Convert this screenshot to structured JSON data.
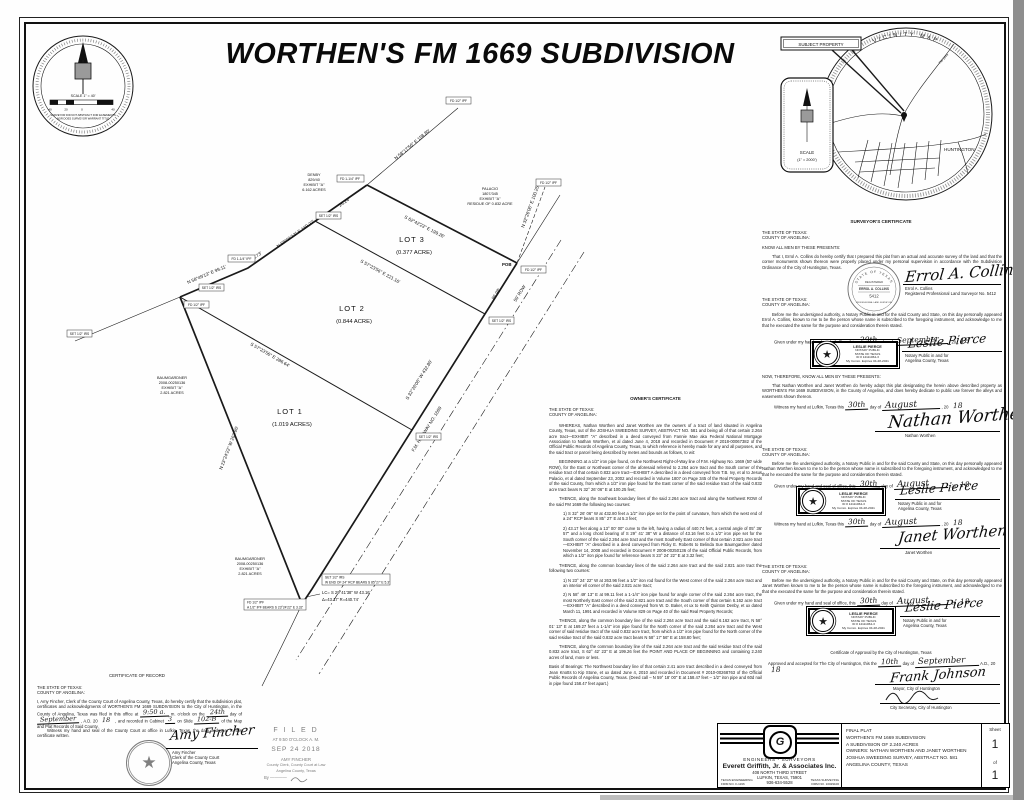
{
  "page": {
    "title": "WORTHEN'S FM 1669 SUBDIVISION"
  },
  "compass": {
    "scale": "SCALE  1\" = 40'",
    "tick1": "40",
    "tick2": "20",
    "tick3": "0",
    "tick4": "40",
    "disclaimer1": "SURVEYOR DID NOT ABSTRACT FOR EASEMENTS",
    "disclaimer2": "NOR DOES SURVEYOR WARRANT TITLE"
  },
  "vicinity": {
    "ring_title": "VICINITY  MAP",
    "subject": "SUBJECT  PROPERTY",
    "town": "HUNTINGTON",
    "road": "FM 1669",
    "scale1": "SCALE",
    "scale2": "(1\" = 2000')"
  },
  "plat": {
    "lot1_name": "LOT 1",
    "lot1_area": "(1.019 ACRES)",
    "lot2_name": "LOT 2",
    "lot2_area": "(0.844 ACRE)",
    "lot3_name": "LOT 3",
    "lot3_area": "(0.377 ACRE)",
    "bearing_ab": "S 62°42'23\" E  199.26'",
    "bearing_div1": "S 57°23'56\" E  221.16'",
    "bearing_div2": "S 57°23'56\" E  286.64'",
    "bearing_cd": "N 23°24'22\" W  263.96'",
    "bearing_df": "N 58°49'13\" E  99.11'",
    "bearing_fa": "N 58°01'13\" E  169.27'",
    "bearing_road": "S 32°26'06\" W  432.80'",
    "bearing_ref_a": "N 58°17'56\" E  158.80'",
    "bearing_ref_b": "N 32°26'06\" E  100.25'",
    "seg_road": "86.98'",
    "seg_fa": "63.73'",
    "seg_ab": "26.24'",
    "road_name": "F.M. HIGHWAY NO. 1669",
    "row": "50' ROW",
    "pob": "POB",
    "curve1": "LC= S 29°41'38\" W  43.16'",
    "curve2": "Δ=43.17'  R=440.74'",
    "m_ipf": "FD 1/2\" IPF",
    "m_ipf114": "FD 1-1/4\" IPF",
    "m_irs": "SET 1/2\" IRS",
    "note_rcp": "W END OF 24\" RCP BEARS S 85°27' E  5.3'",
    "note_ref": "A 1/2\" IPF BEARS S 23°24'22\" E  3.32'",
    "adj_denby": [
      "DENBY",
      "829/40",
      "EXHIBIT \"A\"",
      "6.162 ACRES"
    ],
    "adj_palacio": [
      "PALACIO",
      "1807/345",
      "EXHIBIT \"A\"",
      "RESIDUE OF 0.832 ACRE"
    ],
    "adj_baum": [
      "BAUMGARDNER",
      "2008-00250136",
      "EXHIBIT \"A\"",
      "2.821 ACRES"
    ]
  },
  "common": {
    "state": "THE STATE OF TEXAS:",
    "county": "COUNTY OF ANGELINA:",
    "know_all": "KNOW ALL MEN BY THESE PRESENTS:",
    "day_of": "day of",
    "year_pre": ", 20",
    "given_pre": "Given under my hand and seal of office, this",
    "witness_pre": "Witness my hand at Lufkin, Texas this",
    "notary_cap1": "Notary Public in and for",
    "notary_cap2": "Angelina County, Texas"
  },
  "owner_cert": {
    "heading": "OWNER'S CERTIFICATE",
    "paragraphs": [
      "WHEREAS, Nathan Worthen and Janet Worthen are the owners of a tract of land situated in Angelina County, Texas, out of the JOSHUA SWEEDING SURVEY, ABSTRACT NO. 581 and being all of that certain 2.264 acre tract—EXHIBIT \"A\" described in a deed conveyed from Fannie Mae aka Federal National Mortgage Association to Nathan Worthen, et al dated June 4, 2018 and recorded in Document # 2018-00067382 of the Official Public Records of Angelina County, Texas, to which reference is hereby made for any and all purposes, and the said tract or parcel being described by metes and bounds as follows, to wit:",
      "BEGINNING at a 1/2\" iron pipe found, on the Northwest Right-of-Way line of F.M. Highway No. 1669 (50' wide ROW), for the East or Northeast corner of the aforesaid referred to 2.264 acre tract and the South corner of the residue tract of that certain 0.832 acre tract—EXHIBIT A described in a deed conveyed from T.B. Ivy, et al to Jesus Palacio, et al dated September 23, 2002 and recorded in Volume 1807 on Page 345 of the Real Property Records of the said County, from which a 1/2\" iron pipe found for the East corner of the said residue tract of the said 0.832 acre tract bears N 32° 26' 06\" E at 100.25 feet;",
      "THENCE, along the Southeast boundary lines of the said 2.264 acre tract and along the Northwest ROW of the said FM 1669 the following two courses:",
      "1)   S 32° 26' 06\" W at 432.80 feet a 1/2\" iron pipe set for the point of curvature, from which the west end of a 24\" RCP bears S 85° 27' E at 5.3 feet;",
      "2)   43.17 feet along a 13° 00' 00\" curve to the left, having a radius of 440.74 feet, a central angle of 05° 36' 57\" and a long chord bearing of S 29° 41' 38\" W a distance of 43.16 feet to a 1/2\" iron pipe set for the South corner of the said 2.264 acre tract and the most Southerly East corner of that certain 2.821 acre tract—EXHIBIT \"A\" described in a deed conveyed from Ricky E. Roberts to Belinda Sue Baumgardner dated November 14, 2008 and recorded in Document # 2008-00250136 of the said Official Public Records, from which a 1/2\" iron pipe found for reference bears S 23° 24' 22\" E at 3.32 feet;",
      "THENCE, along the common boundary lines of the said 2.264 acre tract and the said 2.821 acre tract the following two courses:",
      "1)   N 23° 24' 22\" W at 263.96 feet a 1/2\" iron rod found for the West corner of the said 2.264 acre tract and an interior ell corner of the said 2.821 acre tract;",
      "2)   N 58° 49' 13\" E at 99.11 feet a 1-1/4\" iron pipe found for angle corner of the said 2.264 acre tract, the most Northerly East corner of the said 2.821 acre tract and the South corner of that certain 6.162 acre tract—EXHIBIT \"A\" described in a deed conveyed from W. D. Baker, et ux to Keith Quinton Denby, et ux dated March 11, 1991 and recorded in Volume 829 on Page 40 of the said Real Property Records;",
      "THENCE, along the common boundary line of the said 2.264 acre tract and the said 6.162 acre tract, N 58° 01' 13\" E at 169.27 feet a 1-1/4\" iron pipe found for the North corner of the said 2.264 acre tract and the West corner of said residue tract of the said 0.832 acre tract, from which a 1/2\" iron pipe found for the North corner of the said residue tract of the said 0.832 acre tract bears N 58° 17' 56\" E at 158.80 feet;",
      "THENCE, along the common boundary line of the said 2.264 acre tract and the said residue tract of the said 0.832 acre tract, S 62° 42' 23\" E at 199.26 feet the POINT AND PLACE OF BEGINNING and containing 2.240 acres of land, more or less.",
      "Basis of Bearings: The Northwest boundary line of that certain 2.41 acre tract described in a deed conveyed from Jean Knotts to Kip Stone, et ux dated June 4, 2010 and recorded in Document # 2010-00268763 of the Official Public Records of Angelina County, Texas. (Deed call – N 59° 18' 00\" E at 158.47 feet – 1/2\" iron pipe and 60d nail in pipe found 158.47 feet apart.)"
    ]
  },
  "surveyor_cert": {
    "heading": "SURVEYOR'S CERTIFICATE",
    "body": "That I, Errol A. Collins do hereby certify that I prepared this plat from an actual and accurate survey of the land and that the corner monuments shown thereon were properly placed under my personal supervision in accordance with the Subdivision Ordinance of the City of Huntington, Texas.",
    "seal_arc_top": "STATE OF TEXAS",
    "seal_registered": "REGISTERED",
    "seal_name": "ERROL A. COLLINS",
    "seal_num": "5412",
    "seal_bottom": "PROFESSIONAL LAND SURVEYOR",
    "sig": "Errol A. Collins",
    "sig_name": "Errol A. Collins",
    "sig_title": "Registered Professional Land Surveyor No. 5412",
    "ack_body": "Before me the undersigned authority, a Notary Public in and for the said County and State, on this day personally appeared Errol A. Collins, known to me to be the person whose name is subscribed to the foregoing instrument, and acknowledge to me that he executed the same for the purpose and consideration therein stated.",
    "day": "29th",
    "month": "September",
    "year": "18"
  },
  "notary_stamp": {
    "name": "LESLIE PIERCE",
    "l2": "NOTARY PUBLIC",
    "l3": "STATE OF TEXAS",
    "l4": "ID # 12111064-3",
    "l5": "My Comm. Expires 04-28-2021",
    "sig": "Leslie Pierce",
    "star": "★"
  },
  "dedication": {
    "now_therefore": "NOW,  THEREFORE,  KNOW ALL MEN BY THESE PRESENTS:",
    "body": "That Nathan Worthen and Janet Worthen do hereby adopt this plat designating the herein above described property as WORTHEN'S FM 1669 SUBDIVISION, in the County of Angelina, and does hereby dedicate to public use forever the alleys and easements shown thereon.",
    "nathan_day": "30th",
    "nathan_month": "August",
    "nathan_year": "18",
    "nathan_sig": "Nathan Worthen",
    "nathan_name": "Nathan Worthen",
    "janet_day": "30th",
    "janet_month": "August",
    "janet_year": "18",
    "janet_sig": "Janet Worthen",
    "janet_name": "Janet Worthen"
  },
  "ack_nathan": {
    "body": "Before me the undersigned authority, a Notary Public in and for the said County and State, on this day personally appeared Nathan Worthen known to me to be the person whose name is subscribed to the foregoing instrument, and acknowledged to me that he executed the same for the purpose and consideration therein stated.",
    "day": "30th",
    "month": "August",
    "year": "18"
  },
  "ack_janet": {
    "body": "Before me the undersigned authority, a Notary Public in and for the said County and State, on this day personally appeared Janet Worthen known to me to be the person whose name is subscribed to the foregoing instrument, and acknowledged to me that she executed the same for the purpose and consideration therein stated.",
    "day": "30th",
    "month": "August",
    "year": "18"
  },
  "approval": {
    "heading": "Certificate of Approval by the City of Huntington, Texas",
    "line_pre": "Approved and accepted for The City of Huntington, this the",
    "day": "10th",
    "month": "September",
    "ad": "A.D., 20",
    "year": "18",
    "mayor_sig": "Frank Johnson",
    "mayor_cap": "Mayor, City of Huntington",
    "sec_cap": "City Secretary, City of Huntington"
  },
  "record": {
    "heading": "CERTIFICATE OF RECORD",
    "b1": "I, Amy Fincher, Clerk of the County Court of Angelina County, Texas, do hereby certify that the subdivision plat, certificates and acknowledgments of WORTHEN'S FM 1669 SUBDIVISION to the City of Huntington, in the County of Angelina, Texas was filed in this office at",
    "t_time": "9:50 a.",
    "b2": "m. o'clock on the",
    "t_day": "24th",
    "b3": "day of",
    "t_month": "September",
    "b4": ", A.D. 20",
    "t_year": "18",
    "b5": ", and recorded in Cabinet",
    "t_cab": "3",
    "b6": "on Slide",
    "t_slide": "102-B",
    "b7": "of the Map and Plat Records of Said County.",
    "witness": "Witness my hand and seal of the County Court at office in Lufkin, Texas, the date and year in this certificate written.",
    "sig": "Amy Fincher",
    "cap1": "Amy Fincher",
    "cap2": "Clerk of the County Court",
    "cap3": "Angelina County, Texas",
    "seal_star": "★"
  },
  "filed": {
    "l1": "F I L E D",
    "l2": "AT 9:50 O'CLOCK A. M.",
    "l3": "SEP 24 2018",
    "l4": "AMY FINCHER",
    "l5": "County Clerk, County Court at Law",
    "l6": "Angelina County, Texas",
    "l7": "By  ————"
  },
  "title_block": {
    "eng_sur": "ENGINEERS - SURVEYORS",
    "company": "Everett Griffith, Jr. & Associates Inc.",
    "addr1": "408 NORTH THIRD STREET",
    "addr2": "LUFKIN, TEXAS, 75901",
    "phone": "936-634-5528",
    "firm_l1": "TEXAS ENGINEERING",
    "firm_l2": "FIRM NO. F-1196",
    "firm_r1": "TEXAS SURVEYING",
    "firm_r2": "FIRM NO. 10029100",
    "logo_letter": "G",
    "lines": [
      "FINAL PLAT",
      "WORTHEN'S FM 1669 SUBDIVISION",
      "A SUBDIVISION OF 2.240 ACRES",
      "OWNERS: NATHAN WORTHEN AND JANET WORTHEN",
      "JOSHUA SWEEDING SURVEY, ABSTRACT NO. 581",
      "ANGELINA COUNTY, TEXAS"
    ],
    "sheet": "Sheet",
    "n1": "1",
    "of": "of",
    "n2": "1"
  }
}
